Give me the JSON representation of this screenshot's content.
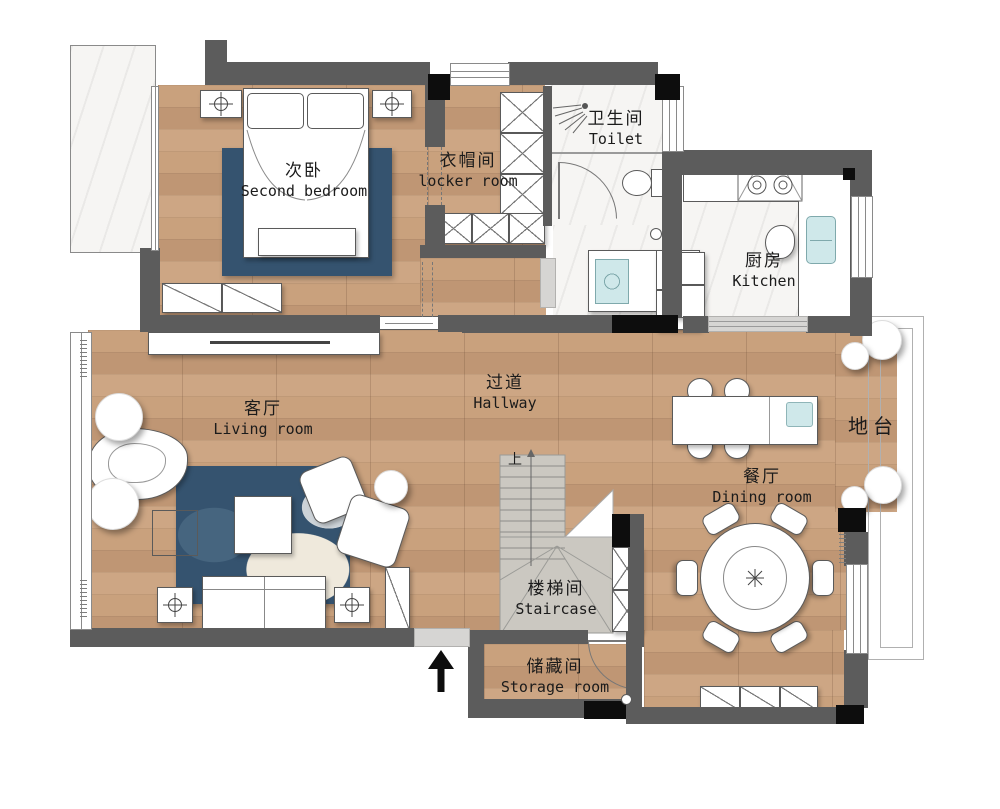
{
  "title": "apartment-floor-plan",
  "rooms": {
    "second_bedroom": {
      "zh": "次卧",
      "en": "Second bedroom"
    },
    "locker_room": {
      "zh": "衣帽间",
      "en": "locker room"
    },
    "toilet": {
      "zh": "卫生间",
      "en": "Toilet"
    },
    "kitchen": {
      "zh": "厨房",
      "en": "Kitchen"
    },
    "hallway": {
      "zh": "过道",
      "en": "Hallway"
    },
    "living_room": {
      "zh": "客厅",
      "en": "Living room"
    },
    "dining_room": {
      "zh": "餐厅",
      "en": "Dining room"
    },
    "staircase": {
      "zh": "楼梯间",
      "en": "Staircase"
    },
    "storage_room": {
      "zh": "储藏间",
      "en": "Storage room"
    },
    "platform": {
      "zh": "地台"
    }
  },
  "annotations": {
    "stairs_up": "上"
  },
  "icons": {
    "ceiling_light": "crosshair-circle",
    "north_arrow": "black-up-arrow",
    "shower": "spray-lines",
    "dining_centerpiece": "asterisk-flower"
  },
  "colors": {
    "wall": "#5c5c5c",
    "column": "#0d0d0d",
    "wood_floor": "#c49c78",
    "marble_floor": "#f6f5f3",
    "stair_floor": "#cbc8c1",
    "rug_blue": "#35536f",
    "appliance_teal": "#cfe8ea",
    "threshold": "#d6d5d3"
  }
}
